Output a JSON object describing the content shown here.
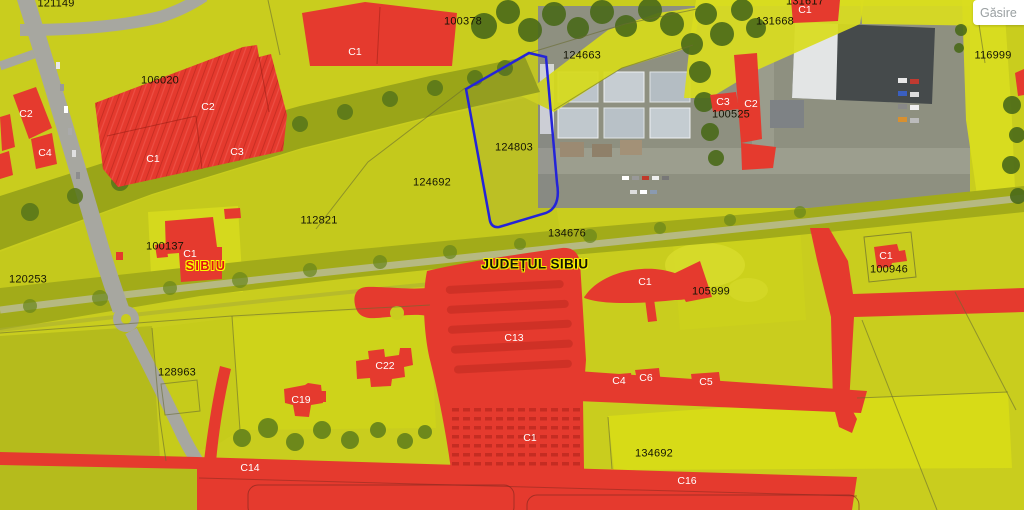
{
  "app": {
    "find_button_label": "Găsire"
  },
  "map": {
    "selected_parcel": "124803",
    "county_label": "JUDEȚUL SIBIU",
    "city_label": "SIBIU",
    "colors": {
      "parcel_overlay_yellow": "#d2d51e",
      "construction_overlay_red": "#e53a2e",
      "selected_parcel_outline_blue": "#2424d8",
      "label_halo_yellow": "#fafa00"
    },
    "labels": [
      {
        "kind": "parcel",
        "text": "121149",
        "x": 56,
        "y": 4
      },
      {
        "kind": "parcel",
        "text": "100378",
        "x": 463,
        "y": 22
      },
      {
        "kind": "parcel",
        "text": "106020",
        "x": 160,
        "y": 81
      },
      {
        "kind": "parcel",
        "text": "124663",
        "x": 582,
        "y": 56
      },
      {
        "kind": "parcel",
        "text": "124803",
        "x": 514,
        "y": 148
      },
      {
        "kind": "parcel",
        "text": "124692",
        "x": 432,
        "y": 183
      },
      {
        "kind": "parcel",
        "text": "112821",
        "x": 319,
        "y": 221
      },
      {
        "kind": "parcel",
        "text": "134676",
        "x": 567,
        "y": 234
      },
      {
        "kind": "parcel",
        "text": "131668",
        "x": 775,
        "y": 22
      },
      {
        "kind": "parcel",
        "text": "131617",
        "x": 805,
        "y": 2
      },
      {
        "kind": "parcel",
        "text": "100525",
        "x": 731,
        "y": 115
      },
      {
        "kind": "parcel",
        "text": "116999",
        "x": 993,
        "y": 56
      },
      {
        "kind": "parcel",
        "text": "100946",
        "x": 889,
        "y": 270
      },
      {
        "kind": "parcel",
        "text": "105999",
        "x": 711,
        "y": 292
      },
      {
        "kind": "parcel",
        "text": "100137",
        "x": 165,
        "y": 247
      },
      {
        "kind": "parcel",
        "text": "120253",
        "x": 28,
        "y": 280
      },
      {
        "kind": "parcel",
        "text": "128963",
        "x": 177,
        "y": 373
      },
      {
        "kind": "parcel",
        "text": "134692",
        "x": 654,
        "y": 454
      },
      {
        "kind": "construction",
        "text": "C1",
        "x": 355,
        "y": 52
      },
      {
        "kind": "construction",
        "text": "C2",
        "x": 208,
        "y": 107
      },
      {
        "kind": "construction",
        "text": "C1",
        "x": 153,
        "y": 159
      },
      {
        "kind": "construction",
        "text": "C3",
        "x": 237,
        "y": 152
      },
      {
        "kind": "construction",
        "text": "C2",
        "x": 26,
        "y": 114
      },
      {
        "kind": "construction",
        "text": "C4",
        "x": 45,
        "y": 153
      },
      {
        "kind": "construction",
        "text": "C3",
        "x": 723,
        "y": 102
      },
      {
        "kind": "construction",
        "text": "C2",
        "x": 751,
        "y": 104
      },
      {
        "kind": "construction",
        "text": "C1",
        "x": 805,
        "y": 10
      },
      {
        "kind": "construction",
        "text": "C1",
        "x": 190,
        "y": 254
      },
      {
        "kind": "construction",
        "text": "C1",
        "x": 645,
        "y": 282
      },
      {
        "kind": "construction",
        "text": "C1",
        "x": 886,
        "y": 256
      },
      {
        "kind": "construction",
        "text": "C13",
        "x": 514,
        "y": 338
      },
      {
        "kind": "construction",
        "text": "C22",
        "x": 385,
        "y": 366
      },
      {
        "kind": "construction",
        "text": "C4",
        "x": 619,
        "y": 381
      },
      {
        "kind": "construction",
        "text": "C6",
        "x": 646,
        "y": 378
      },
      {
        "kind": "construction",
        "text": "C5",
        "x": 706,
        "y": 382
      },
      {
        "kind": "construction",
        "text": "C19",
        "x": 301,
        "y": 400
      },
      {
        "kind": "construction",
        "text": "C1",
        "x": 530,
        "y": 438
      },
      {
        "kind": "construction",
        "text": "C14",
        "x": 250,
        "y": 468
      },
      {
        "kind": "construction",
        "text": "C16",
        "x": 687,
        "y": 481
      }
    ]
  }
}
